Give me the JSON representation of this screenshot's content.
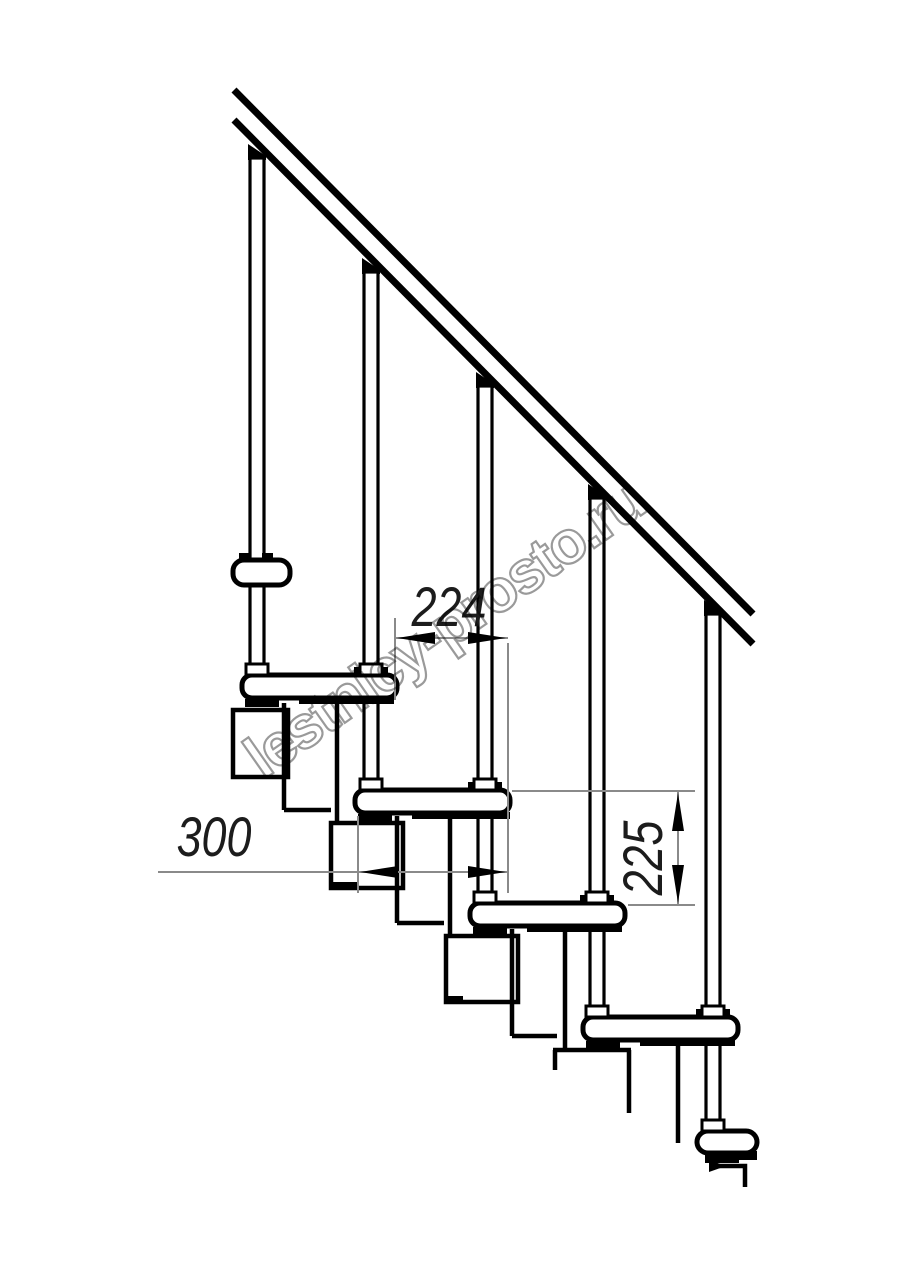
{
  "watermark": {
    "text": "lestnicy-prosto.ru",
    "color": "#9a9a9a"
  },
  "dimensions": {
    "tread_spacing": "224",
    "tread_length": "300",
    "step_rise": "225"
  },
  "colors": {
    "outline": "#000000",
    "dimension_lines": "#8a8a8a",
    "background": "#ffffff"
  }
}
